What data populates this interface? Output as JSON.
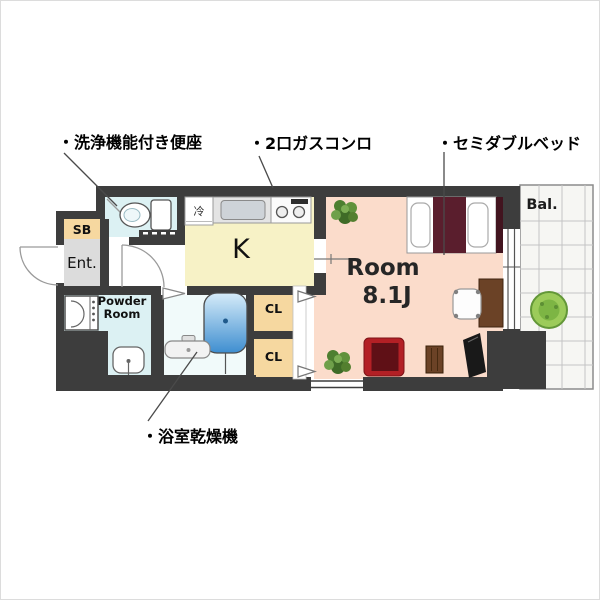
{
  "floorplan": {
    "annotations": {
      "washlet": "・洗浄機能付き便座",
      "gas_stove": "・2口ガスコンロ",
      "semi_double_bed": "・セミダブルベッド",
      "bathroom_dryer": "・浴室乾燥機"
    },
    "rooms": {
      "entrance": "Ent.",
      "shoe_box": "SB",
      "powder_room_line1": "Powder",
      "powder_room_line2": "Room",
      "kitchen": "K",
      "main_room": "Room",
      "main_room_size": "8.1J",
      "closet_upper": "CL",
      "closet_lower": "CL",
      "balcony": "Bal.",
      "refrigerator_space": "冷"
    },
    "colors": {
      "wall": "#3d3d3d",
      "kitchen_floor": "#f7f2c6",
      "room_floor": "#fbdccb",
      "wet_area_floor": "#dcf1f3",
      "bath_floor": "#f1fafa",
      "closet": "#f6d8a0",
      "entrance_floor": "#dcdcdc",
      "balcony_floor": "#f6f6f3",
      "bed_cover": "#5a1e2d",
      "sofa": "#b32025",
      "bathtub": "#3e8ed0",
      "desk": "#6b4226",
      "plant": "#4d7f30",
      "bush": "#9ccb5a"
    }
  }
}
